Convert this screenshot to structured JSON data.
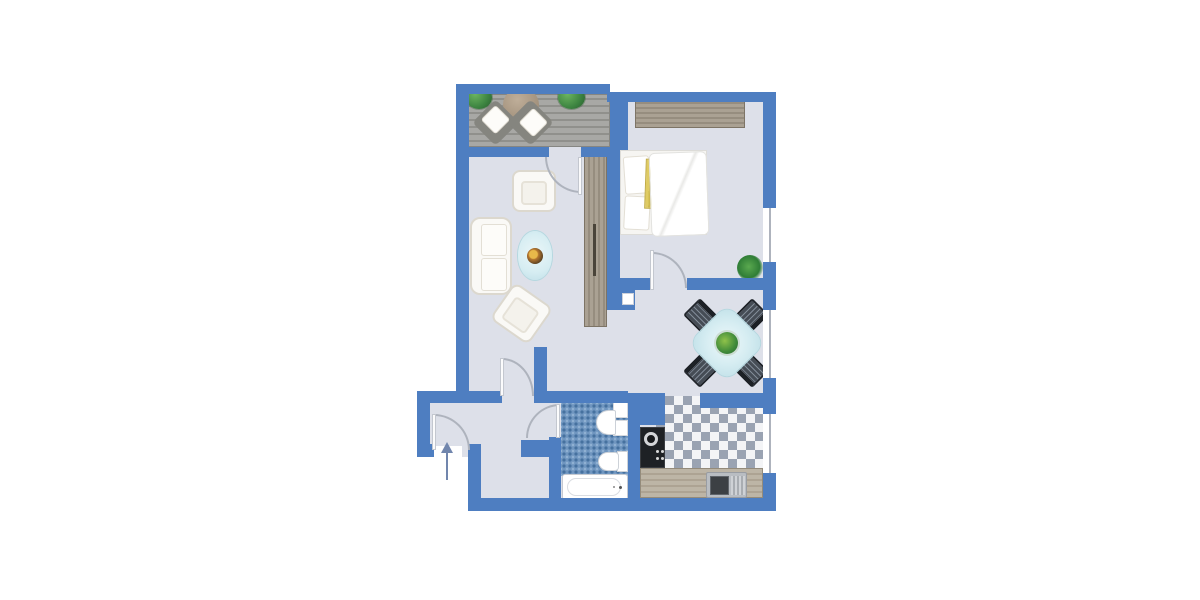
{
  "title": "apartment-floor-plan",
  "plan_type": "1-room apartment top-view floor plan, no text labels",
  "colors": {
    "wall": "#4e7ec1",
    "floor": "#dde0e9",
    "deckLight": "#a8a8a5",
    "deckDark": "#90908c",
    "woodLight": "#aaa193",
    "woodDark": "#968d7f",
    "counterLight": "#bdb5a6",
    "counterDark": "#ada393",
    "tileBase": "#6f95bf",
    "tileDark": "#46719f",
    "tileLight": "#8fb0d2",
    "checkerBg": "#f3f4f6",
    "checkerTile": "#9aa3b2",
    "glass": "#d6edf2",
    "glassEdge": "#c0e0e8",
    "chairDark": "#3f464e",
    "plantGreen": "#3c8340",
    "accentYellow": "#dfcb63",
    "arrow": "#7186ad",
    "arc": "#aeb3bd",
    "furnEdge": "#dcd8ce"
  },
  "rooms": [
    {
      "name": "balcony",
      "floor": "wood-deck",
      "furniture": [
        "plant",
        "plant",
        "round-table",
        "lounge-chair",
        "lounge-chair"
      ]
    },
    {
      "name": "living-room",
      "floor": "light-gray",
      "furniture": [
        "armchair",
        "sofa",
        "oval-coffee-table",
        "fruit-bowl",
        "armchair",
        "tall-wardrobe"
      ]
    },
    {
      "name": "bedroom",
      "floor": "light-gray",
      "furniture": [
        "wardrobe",
        "double-bed",
        "pillows",
        "yellow-blanket",
        "duvet",
        "potted-plant"
      ]
    },
    {
      "name": "dining-area",
      "floor": "light-gray",
      "furniture": [
        "square-glass-table",
        "centerpiece-plant",
        "chair",
        "chair",
        "chair",
        "chair"
      ]
    },
    {
      "name": "bathroom",
      "floor": "blue-mosaic-tile",
      "furniture": [
        "washbasin",
        "cabinet",
        "cabinet",
        "toilet",
        "bathtub"
      ]
    },
    {
      "name": "kitchen",
      "floor": "gray-white-diamond-checker",
      "furniture": [
        "cooktop",
        "counter",
        "sink"
      ]
    },
    {
      "name": "entrance-hall",
      "floor": "light-gray",
      "furniture": []
    },
    {
      "name": "storage-nook",
      "floor": "light-gray",
      "furniture": []
    }
  ],
  "symbols": {
    "entrance_arrow": "arrow pointing up into entry door",
    "windows": 3,
    "door_swings": 5
  }
}
